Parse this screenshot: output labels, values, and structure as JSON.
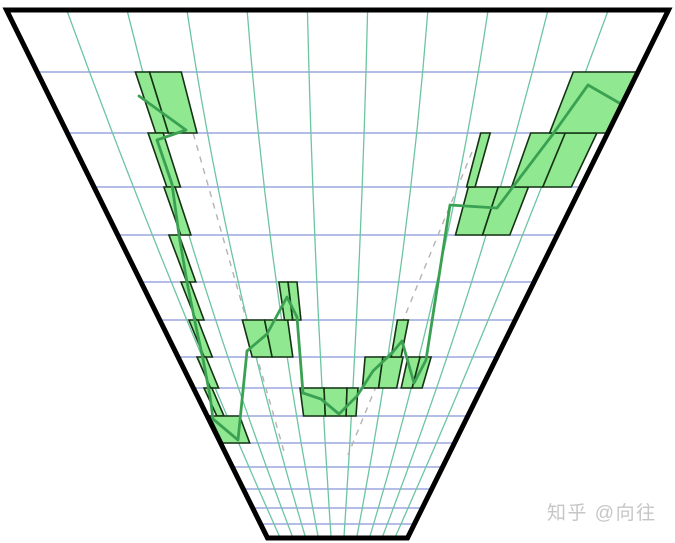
{
  "figure": {
    "width": 675,
    "height": 543,
    "background": "#ffffff",
    "description": "Perspective funnel grid with green candlestick bars, trend line and dashed guides"
  },
  "trapezoid": {
    "center_x": 337.5,
    "top_y": 10,
    "bottom_y": 538,
    "top_half_width": 331,
    "bottom_half_width": 70,
    "border_color": "#000000",
    "border_width": 5
  },
  "grid": {
    "horizontal_color": "#8893d9",
    "vertical_color": "#6cc5a0",
    "stroke_width": 1.3,
    "horizontal_lines_y": [
      72,
      133,
      187,
      235,
      282,
      320,
      357,
      388,
      416,
      443,
      467,
      489,
      508,
      524
    ],
    "vertical_fractions": [
      -0.818,
      -0.636,
      -0.455,
      -0.273,
      -0.091,
      0.091,
      0.273,
      0.455,
      0.636,
      0.818
    ],
    "vertical_bow_px": 10
  },
  "dashed_guides": {
    "color": "#b3b3b3",
    "stroke_width": 1.4,
    "dash_pattern": "6 6",
    "lines": [
      {
        "x1": 190,
        "y1": 122,
        "x2": 285,
        "y2": 455
      },
      {
        "x1": 472,
        "y1": 152,
        "x2": 348,
        "y2": 455
      }
    ]
  },
  "candles": {
    "fill": "#90e890",
    "stroke": "#143214",
    "stroke_width": 1.6,
    "items": [
      {
        "f1": -0.673,
        "f2": -0.626,
        "y1": 72,
        "y2": 133
      },
      {
        "f1": -0.626,
        "f2": -0.52,
        "y1": 72,
        "y2": 133
      },
      {
        "f1": -0.701,
        "f2": -0.645,
        "y1": 133,
        "y2": 187
      },
      {
        "f1": -0.713,
        "f2": -0.667,
        "y1": 187,
        "y2": 235
      },
      {
        "f1": -0.767,
        "f2": -0.721,
        "y1": 235,
        "y2": 282
      },
      {
        "f1": -0.796,
        "f2": -0.751,
        "y1": 282,
        "y2": 320
      },
      {
        "f1": -0.836,
        "f2": -0.785,
        "y1": 320,
        "y2": 357
      },
      {
        "f1": -0.881,
        "f2": -0.825,
        "y1": 357,
        "y2": 388
      },
      {
        "f1": -0.926,
        "f2": -0.871,
        "y1": 388,
        "y2": 416
      },
      {
        "f1": -0.982,
        "f2": -0.751,
        "y1": 416,
        "y2": 443
      },
      {
        "f1": -0.535,
        "f2": -0.41,
        "y1": 320,
        "y2": 357
      },
      {
        "f1": -0.41,
        "f2": -0.28,
        "y1": 320,
        "y2": 357
      },
      {
        "f1": -0.298,
        "f2": -0.252,
        "y1": 282,
        "y2": 320
      },
      {
        "f1": -0.252,
        "f2": -0.206,
        "y1": 282,
        "y2": 320
      },
      {
        "f1": -0.26,
        "f2": -0.094,
        "y1": 388,
        "y2": 416
      },
      {
        "f1": -0.094,
        "f2": 0.066,
        "y1": 388,
        "y2": 416
      },
      {
        "f1": 0.066,
        "f2": 0.142,
        "y1": 388,
        "y2": 416
      },
      {
        "f1": 0.173,
        "f2": 0.285,
        "y1": 357,
        "y2": 388
      },
      {
        "f1": 0.285,
        "f2": 0.411,
        "y1": 357,
        "y2": 388
      },
      {
        "f1": 0.337,
        "f2": 0.399,
        "y1": 320,
        "y2": 357
      },
      {
        "f1": 0.442,
        "f2": 0.518,
        "y1": 357,
        "y2": 388
      },
      {
        "f1": 0.518,
        "f2": 0.587,
        "y1": 357,
        "y2": 388
      },
      {
        "f1": 0.537,
        "f2": 0.66,
        "y1": 187,
        "y2": 235
      },
      {
        "f1": 0.66,
        "f2": 0.784,
        "y1": 187,
        "y2": 235
      },
      {
        "f1": 0.53,
        "f2": 0.565,
        "y1": 133,
        "y2": 187
      },
      {
        "f1": 0.715,
        "f2": 0.843,
        "y1": 133,
        "y2": 187
      },
      {
        "f1": 0.843,
        "f2": 0.96,
        "y1": 133,
        "y2": 187
      },
      {
        "f1": 0.785,
        "f2": 1.0,
        "y1": 72,
        "y2": 133
      }
    ]
  },
  "trend_line": {
    "color": "#3aa152",
    "stroke_width": 2.8,
    "points": [
      [
        139,
        96
      ],
      [
        150,
        104
      ],
      [
        186,
        130
      ],
      [
        157,
        140
      ],
      [
        172,
        184
      ],
      [
        179,
        235
      ],
      [
        187,
        282
      ],
      [
        195,
        322
      ],
      [
        203,
        359
      ],
      [
        210,
        396
      ],
      [
        213,
        419
      ],
      [
        238,
        440
      ],
      [
        247,
        351
      ],
      [
        267,
        334
      ],
      [
        287,
        297
      ],
      [
        297,
        317
      ],
      [
        303,
        393
      ],
      [
        321,
        399
      ],
      [
        339,
        414
      ],
      [
        357,
        396
      ],
      [
        373,
        371
      ],
      [
        392,
        353
      ],
      [
        402,
        341
      ],
      [
        414,
        383
      ],
      [
        426,
        360
      ],
      [
        450,
        205
      ],
      [
        497,
        208
      ],
      [
        553,
        134
      ],
      [
        588,
        85
      ],
      [
        628,
        108
      ]
    ]
  },
  "watermark": {
    "text": "知乎 @向往",
    "color": "#c6c6c6",
    "font_size": 19
  }
}
